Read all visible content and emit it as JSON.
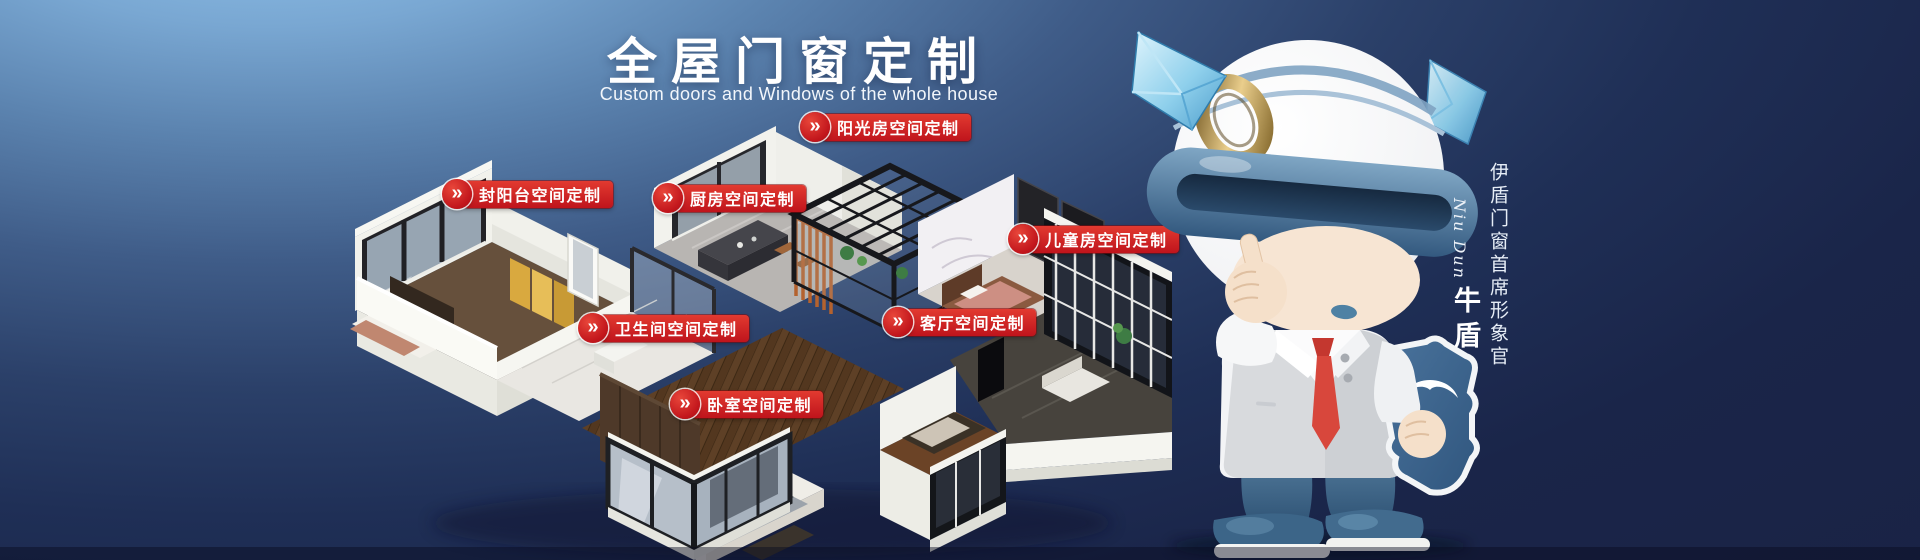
{
  "banner": {
    "title": "全屋门窗定制",
    "subtitle": "Custom doors and Windows of the whole house"
  },
  "room_labels": [
    {
      "text": "阳光房空间定制"
    },
    {
      "text": "封阳台空间定制"
    },
    {
      "text": "厨房空间定制"
    },
    {
      "text": "儿童房空间定制"
    },
    {
      "text": "卫生间空间定制"
    },
    {
      "text": "客厅空间定制"
    },
    {
      "text": "卧室空间定制"
    }
  ],
  "icons": {
    "double_chevron": "»"
  },
  "mascot": {
    "role_vertical": "伊盾门窗首席形象官",
    "signature": "Niu Dun",
    "name": "牛盾"
  },
  "colors": {
    "bg_light": "#8FC3EC",
    "bg_dark": "#1A2347",
    "label_red": "#C8151C"
  }
}
